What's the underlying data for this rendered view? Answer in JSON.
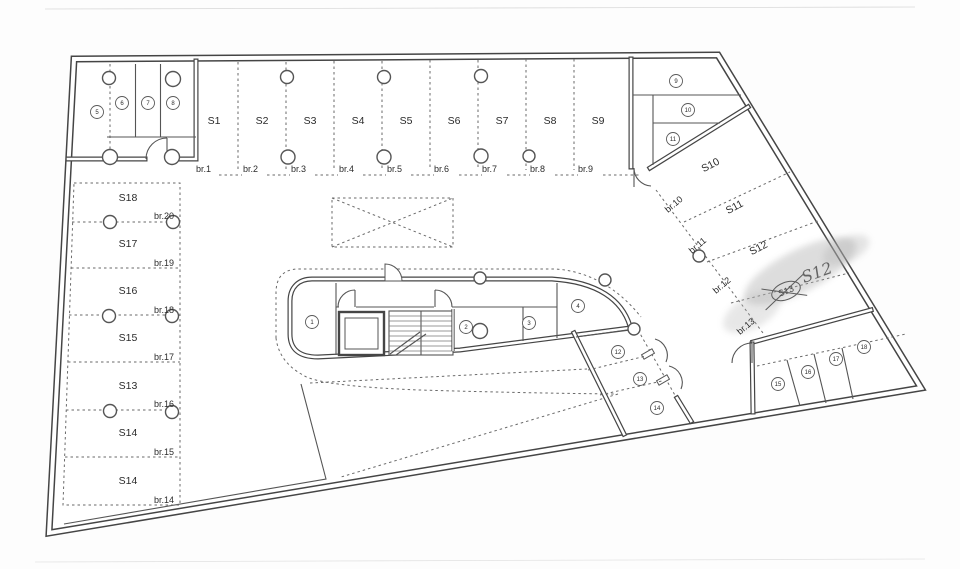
{
  "top_row": {
    "spaces": [
      "S1",
      "S2",
      "S3",
      "S4",
      "S5",
      "S6",
      "S7",
      "S8",
      "S9"
    ],
    "doors": [
      "br.1",
      "br.2",
      "br.3",
      "br.4",
      "br.5",
      "br.6",
      "br.7",
      "br.8",
      "br.9"
    ]
  },
  "left_column": {
    "spaces": [
      "S18",
      "S17",
      "S16",
      "S15",
      "S13",
      "S14",
      "S14"
    ],
    "doors": [
      "br.20",
      "br.19",
      "br.18",
      "br.17",
      "br.16",
      "br.15",
      "br.14"
    ]
  },
  "diagonal_row": {
    "spaces": [
      "S10",
      "S11",
      "S12"
    ],
    "doors": [
      "br.10",
      "br.11",
      "br.12",
      "br.13"
    ],
    "crossed_out": "S13",
    "handwritten": "S12"
  },
  "units": {
    "core": [
      "1",
      "2",
      "3",
      "4"
    ],
    "top_left": [
      "5",
      "6",
      "7",
      "8"
    ],
    "top_right": [
      "9",
      "10",
      "11"
    ],
    "mid_right": [
      "12",
      "13",
      "14"
    ],
    "bottom_right": [
      "15",
      "16",
      "17",
      "18"
    ]
  }
}
